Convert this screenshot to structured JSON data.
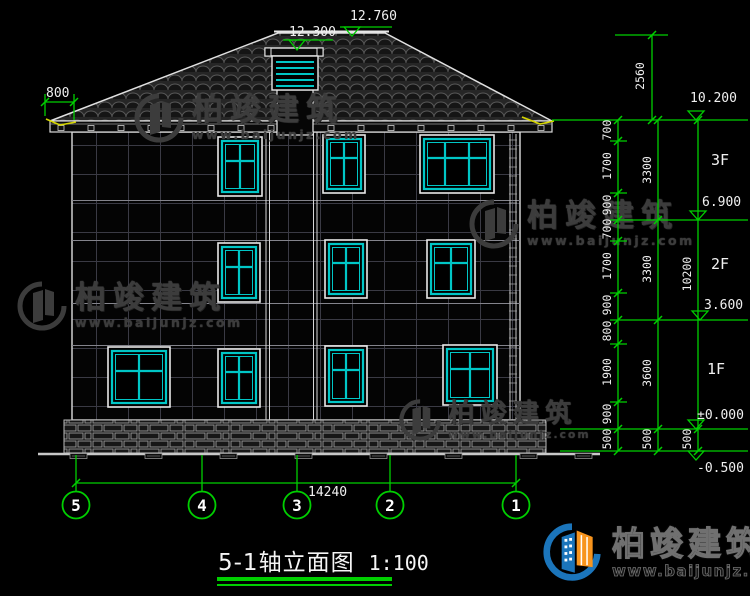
{
  "drawing": {
    "title": "5-1轴立面图",
    "scale": "1:100",
    "top_dimensions": {
      "eave_overhang": "800",
      "vent_elevation": "12.300",
      "ridge_elevation": "12.760"
    },
    "right_dimensions": {
      "roof_height": "2560",
      "col1": [
        "700",
        "1700",
        "900",
        "700",
        "1700",
        "900",
        "800",
        "1900",
        "900",
        "500"
      ],
      "col2": [
        "3300",
        "3300",
        "3600",
        "500"
      ],
      "col3": [
        "10200",
        "500"
      ],
      "elevations": [
        "10.200",
        "6.900",
        "3.600",
        "±0.000",
        "-0.500"
      ],
      "floors": [
        "3F",
        "2F",
        "1F"
      ]
    },
    "bottom": {
      "total_width": "14240",
      "axis_labels": [
        "5",
        "4",
        "3",
        "2",
        "1"
      ]
    }
  },
  "brand": {
    "name": "柏竣建筑",
    "url": "www.baijunjz.com"
  },
  "colors": {
    "dimension_green": "#00cf00",
    "window_cyan": "#00c6c6",
    "accent_yellow": "#d6d600",
    "logo_blue": "#1b75bb",
    "logo_orange": "#f7941d"
  }
}
